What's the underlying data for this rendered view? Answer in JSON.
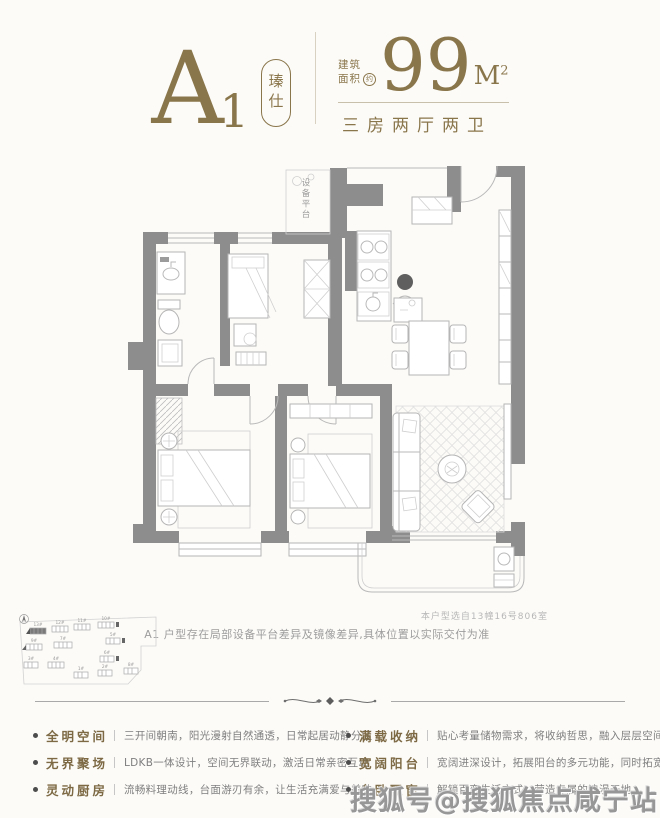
{
  "header": {
    "plan_letter": "A",
    "plan_number": "1",
    "badge_label": "瑧仕",
    "area_prefix_line1": "建筑",
    "area_prefix_line2": "面积",
    "area_approx": "约",
    "area_value": "99",
    "area_unit_m": "M",
    "area_unit_exp": "2",
    "layout_label": "三房两厅两卫"
  },
  "floorplan": {
    "equipment_platform_label": "设备平台",
    "selection_note": "本户型选自13幢16号806室",
    "disclaimer": "A1 户型存在局部设备平台差异及镜像差异,具体位置以实际交付为准"
  },
  "siteplan": {
    "buildings": [
      {
        "label": "13#"
      },
      {
        "label": "12#"
      },
      {
        "label": "11#"
      },
      {
        "label": "10#"
      },
      {
        "label": "9#"
      },
      {
        "label": "7#"
      },
      {
        "label": "5#"
      },
      {
        "label": "3#"
      },
      {
        "label": "4#"
      },
      {
        "label": "6#"
      },
      {
        "label": "1#"
      },
      {
        "label": "2#"
      },
      {
        "label": "8#"
      }
    ]
  },
  "features": {
    "left": [
      {
        "label": "全明空间",
        "desc": "三开间朝南，阳光漫射自然通透，日常起居动静分区"
      },
      {
        "label": "无界聚场",
        "desc": "LDKB一体设计，空间无界联动，激活日常亲密互动"
      },
      {
        "label": "灵动厨房",
        "desc": "流畅料理动线，台面游刃有余，让生活充满爱与美味"
      }
    ],
    "right": [
      {
        "label": "满载收纳",
        "desc": "贴心考量储物需求，将收纳哲思，融入层层空间设计"
      },
      {
        "label": "宽阔阳台",
        "desc": "宽阔进深设计，拓展阳台的多元功能，同时拓宽视界"
      },
      {
        "label": "全卧飘窗",
        "desc": "解锁百变生活方式，营造专属的浪漫天地"
      }
    ]
  },
  "watermark": "搜狐号@搜狐焦点咸宁站",
  "colors": {
    "gold": "#8a764b",
    "wall_gray": "#8d8d8d",
    "furniture_gray": "#b5b5b5",
    "text_gray": "#7f7f7f"
  }
}
